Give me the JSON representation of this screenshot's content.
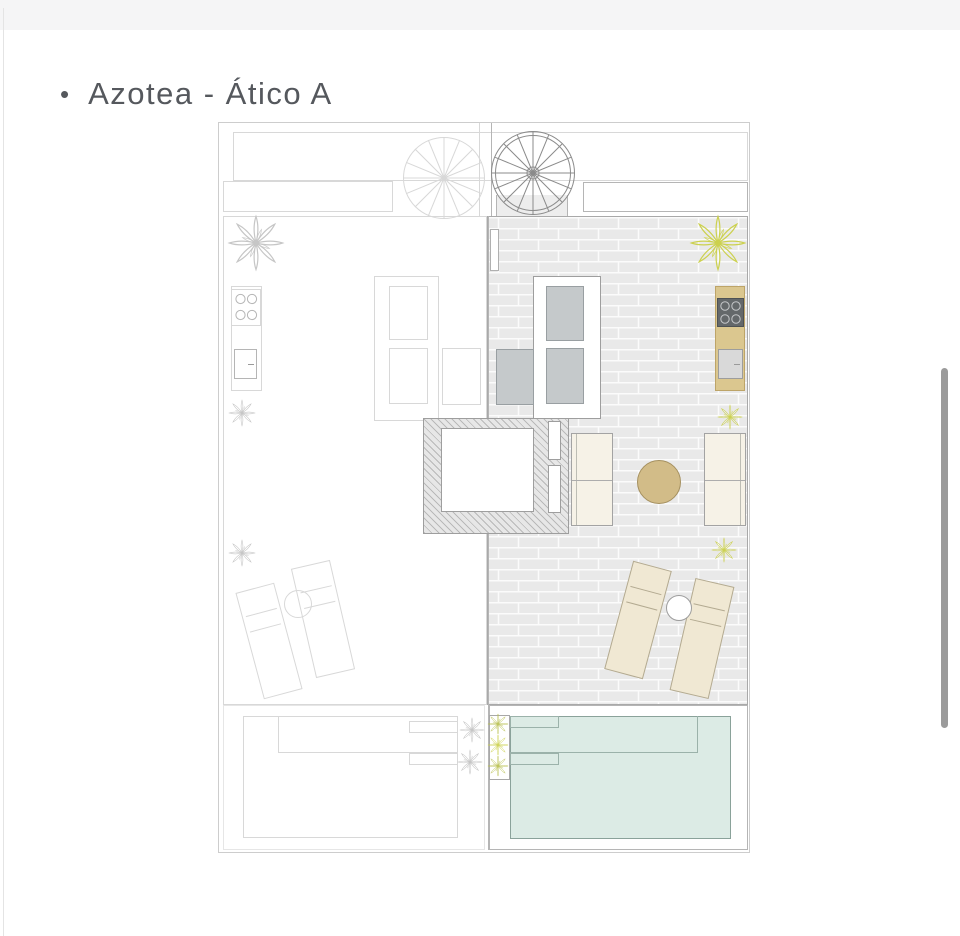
{
  "header": {
    "bullet": "•",
    "title": "Azotea - Ático A"
  },
  "plan": {
    "features": [
      "spiral-staircase-left",
      "spiral-staircase-right",
      "terrace-left-unit-b",
      "terrace-right-unit-a",
      "outdoor-kitchen-left",
      "outdoor-kitchen-right",
      "corner-sofa-left",
      "corner-sofa-right",
      "elevator-stair-core",
      "facing-sofas",
      "round-table",
      "sun-loungers-left",
      "sun-loungers-right",
      "pool-left",
      "pool-right",
      "planter-divider",
      "plants"
    ]
  },
  "palette": {
    "page_bg": "#ffffff",
    "topbar_bg": "#f5f5f6",
    "edge_line": "#e4e4e4",
    "title_color": "#55585d",
    "line_light": "#d8d8d8",
    "line_mid": "#b5b5b5",
    "paving": "#e9e9e9",
    "mortar": "#fbfbfb",
    "cushion": "#c5c9cb",
    "cushion_line": "#999fa2",
    "sofa_cream": "#f6f2e7",
    "lounger_cream": "#f0e8d3",
    "lounger_line": "#b3aa91",
    "table_tan": "#d2bc88",
    "table_line": "#a5905f",
    "counter_beige": "#dbc78f",
    "counter_line": "#bda468",
    "stove_dark": "#64686a",
    "burner_ring": "#c6c8ca",
    "sink_gray": "#d9d9d9",
    "pool_fill": "#dcebe5",
    "pool_line": "#8aa29a",
    "plant_yellow": "#ccd14f",
    "plant_olive": "#b9c050",
    "plant_gray": "#c6c6c6",
    "hatch_bg": "#e7e7e7",
    "hatch_line": "#9e9e9e",
    "scrollbar": "#9b9b9b"
  }
}
